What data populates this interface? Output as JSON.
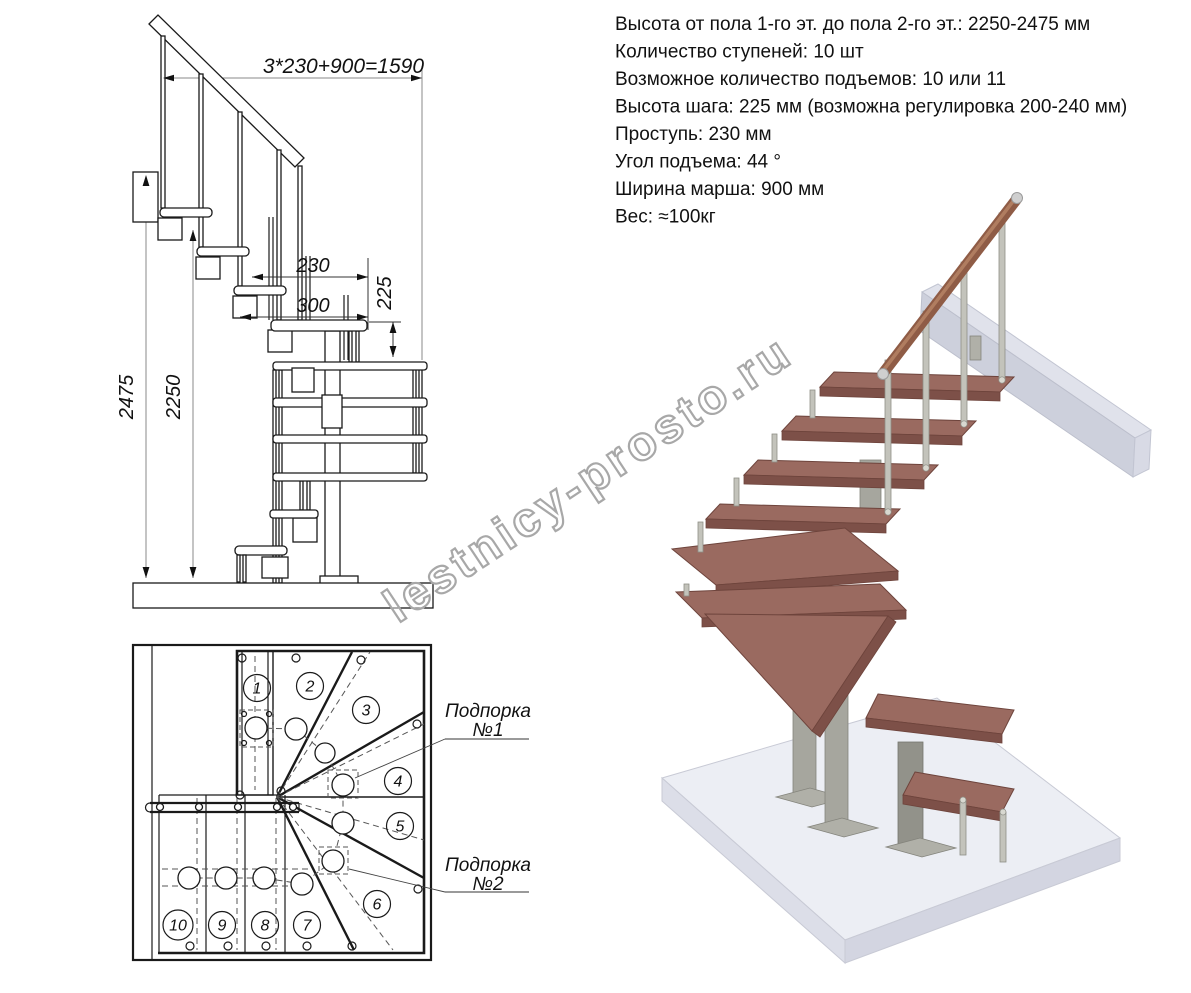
{
  "specs": {
    "lines": [
      "Высота от пола 1-го эт. до пола 2-го эт.: 2250-2475 мм",
      "Количество ступеней: 10 шт",
      "Возможное количество подъемов: 10 или 11",
      "Высота шага: 225 мм (возможна регулировка 200-240 мм)",
      "Проступь: 230 мм",
      "Угол подъема: 44 °",
      "Ширина марша: 900 мм",
      "Вес: ≈100кг"
    ]
  },
  "elevation": {
    "dim_width_formula": "3*230+900=1590",
    "dim_tread_depth": "230",
    "dim_module_depth": "300",
    "dim_step_height": "225",
    "dim_total_height_max": "2475",
    "dim_total_height_min": "2250"
  },
  "plan": {
    "step_numbers": [
      "1",
      "2",
      "3",
      "4",
      "5",
      "6",
      "7",
      "8",
      "9",
      "10"
    ],
    "support1_line1": "Подпорка",
    "support1_line2": "№1",
    "support2_line1": "Подпорка",
    "support2_line2": "№2"
  },
  "watermark": {
    "text": "lestnicy-prosto.ru"
  }
}
